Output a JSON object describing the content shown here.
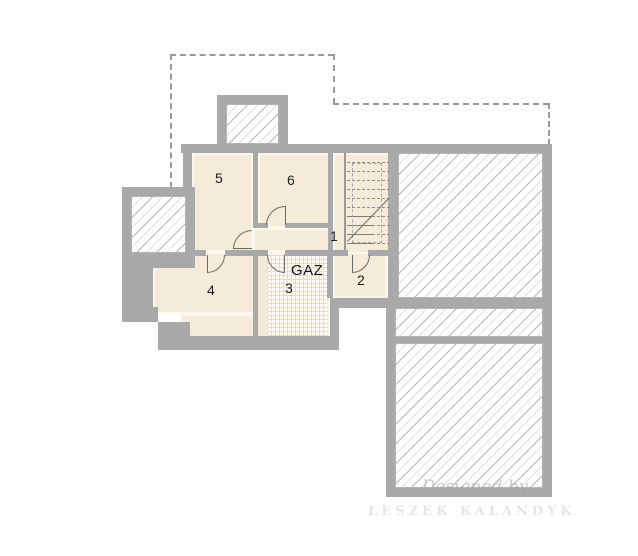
{
  "plan": {
    "title": "basement-floor-plan",
    "rooms": [
      {
        "id": "1",
        "label": "1"
      },
      {
        "id": "2",
        "label": "2"
      },
      {
        "id": "3",
        "label": "3"
      },
      {
        "id": "4",
        "label": "4"
      },
      {
        "id": "5",
        "label": "5"
      },
      {
        "id": "6",
        "label": "6"
      }
    ],
    "gas_label": "GAZ",
    "watermark": {
      "line1": "Designed by",
      "line2": "LESZEK KALANDYK"
    },
    "colors": {
      "wall": "#a9a9a9",
      "floor": "#f5ebd9",
      "hatch_line": "#c9c9c9",
      "grid_floor_line": "#e7dbc1",
      "dashed_outline": "#999999",
      "label": "#1c1c1c"
    }
  }
}
